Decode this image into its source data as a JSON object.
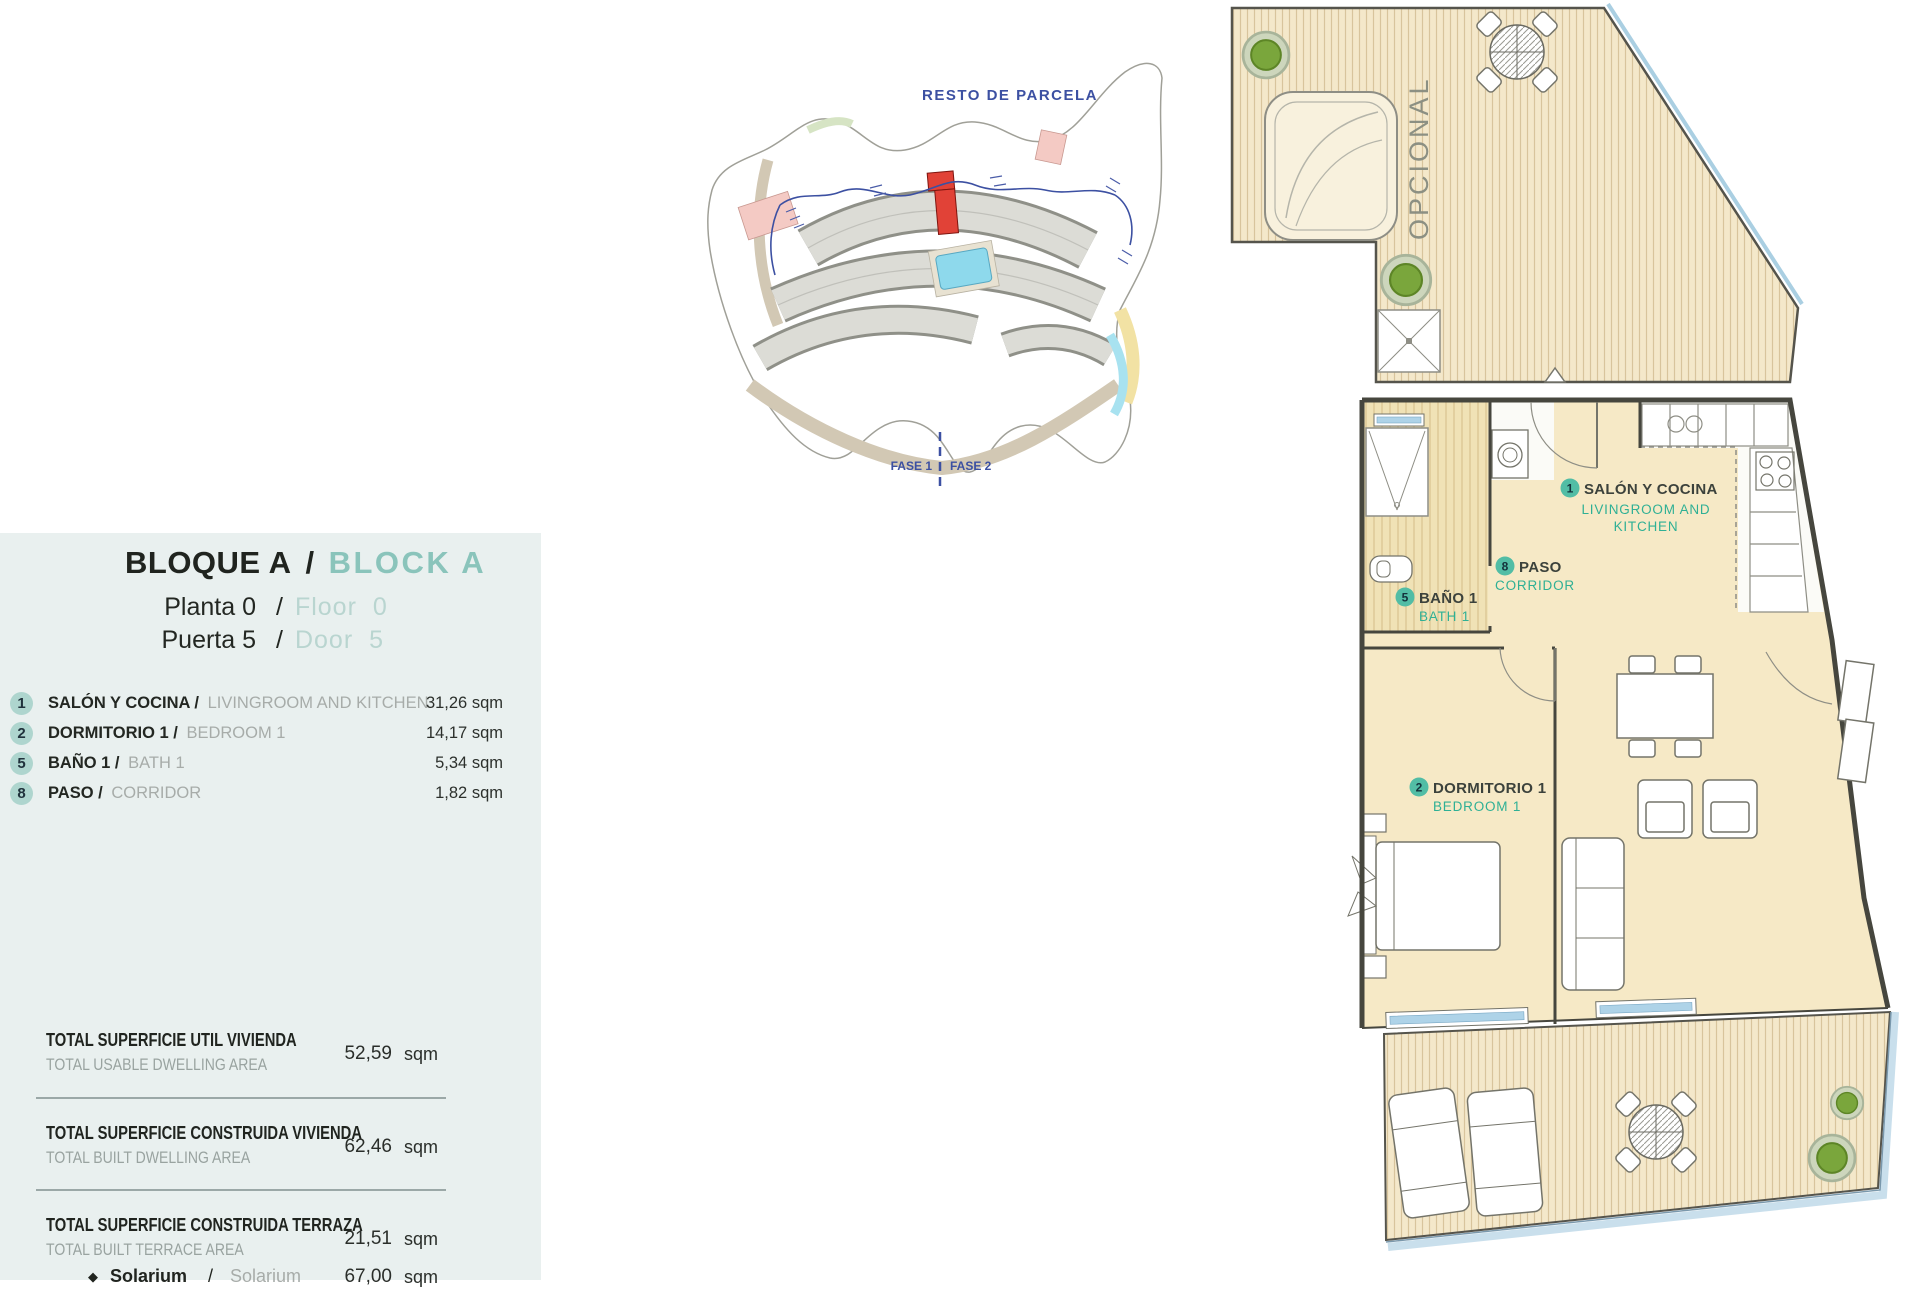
{
  "panel": {
    "block_es": "BLOQUE A",
    "sep": "/",
    "block_en": "BLOCK A",
    "floor_es": "Planta 0",
    "floor_en": "Floor 0",
    "door_es": "Puerta 5",
    "door_en": "Door 5",
    "rooms": [
      {
        "num": "1",
        "name_es": "SALÓN Y COCINA /",
        "name_en": "LIVINGROOM AND KITCHEN",
        "area": "31,26",
        "unit": "sqm"
      },
      {
        "num": "2",
        "name_es": "DORMITORIO 1 /",
        "name_en": "BEDROOM 1",
        "area": "14,17",
        "unit": "sqm"
      },
      {
        "num": "5",
        "name_es": "BAÑO 1 /",
        "name_en": "BATH 1",
        "area": "5,34",
        "unit": "sqm"
      },
      {
        "num": "8",
        "name_es": "PASO /",
        "name_en": "CORRIDOR",
        "area": "1,82",
        "unit": "sqm"
      }
    ],
    "totals": [
      {
        "title_es": "TOTAL SUPERFICIE UTIL VIVIENDA",
        "title_en": "TOTAL USABLE DWELLING AREA",
        "value": "52,59",
        "unit": "sqm"
      },
      {
        "title_es": "TOTAL SUPERFICIE CONSTRUIDA VIVIENDA",
        "title_en": "TOTAL BUILT DWELLING AREA",
        "value": "62,46",
        "unit": "sqm"
      },
      {
        "title_es": "TOTAL SUPERFICIE CONSTRUIDA TERRAZA",
        "title_en": "TOTAL BUILT TERRACE AREA",
        "value": "21,51",
        "unit": "sqm"
      }
    ],
    "solarium_row": {
      "marker": "◆",
      "name_es": "Solarium",
      "sep": "/",
      "name_en": "Solarium",
      "value": "67,00",
      "unit": "sqm"
    }
  },
  "site_plan": {
    "resto": "RESTO DE PARCELA",
    "fase1": "FASE 1",
    "fase2": "FASE 2"
  },
  "floor_plan": {
    "salon": {
      "num": "1",
      "es": "SALÓN Y COCINA",
      "en_line1": "LIVINGROOM AND",
      "en_line2": "KITCHEN"
    },
    "paso": {
      "num": "8",
      "es": "PASO",
      "en": "CORRIDOR"
    },
    "bano": {
      "num": "5",
      "es": "BAÑO 1",
      "en": "BATH 1"
    },
    "dormitorio": {
      "num": "2",
      "es": "DORMITORIO 1",
      "en": "BEDROOM 1"
    },
    "opcional": "OPCIONAL"
  },
  "colors": {
    "panel_bg": "#e9f0ef",
    "badge_bg": "#aed5ce",
    "accent_teal": "#2fb095",
    "header_teal": "#8ac4bb",
    "site_blue": "#3c50a2",
    "red_unit": "#e14237",
    "floor_cream": "#f6e9c6",
    "deck_wood": "#f4e8ca",
    "glass_blue": "#aed3e8"
  }
}
